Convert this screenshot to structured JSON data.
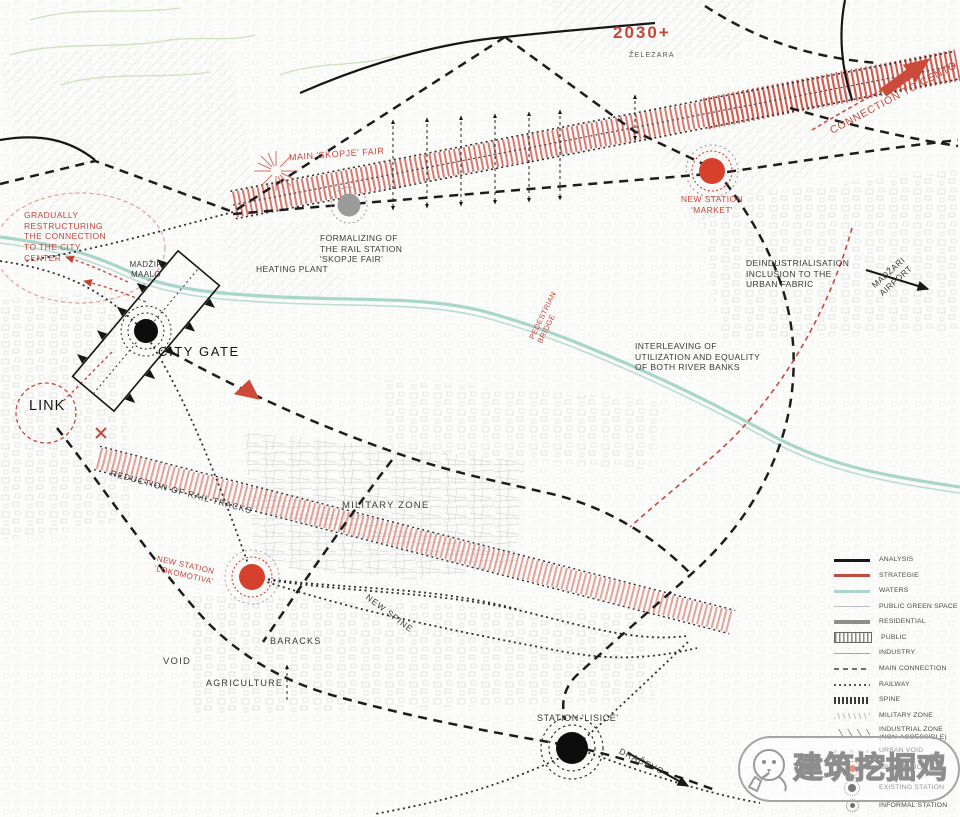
{
  "meta": {
    "year": "2030+",
    "district": "ŽELEZARA"
  },
  "labels": {
    "connection_cento": "CONNECTION TO CENTO",
    "main_fair": "MAIN 'SKOPJE' FAIR",
    "new_station_market": "NEW STATION\n'MARKET'",
    "formalizing": "FORMALIZING OF\nTHE RAIL STATION\n'SKOPJE FAIR'",
    "heating_plant": "HEATING PLANT",
    "deindustrialisation": "DEINDUSTRIALISATION\nINCLUSION TO THE\nURBAN FABRIC",
    "gradually": "GRADUALLY\nRESTRUCTURING\nTHE CONNECTION\nTO THE CITY\nCENTER",
    "madzir_maalo": "MADŽIR\nMAALO",
    "city_gate": "CITY GATE",
    "link": "LINK",
    "interleaving": "INTERLEAVING OF\nUTILIZATION AND EQUALITY\nOF BOTH RIVER BANKS",
    "madzari_airport": "MADŽARI\nAIRPORT",
    "pedestrian_bridge": "PEDESTRIAN\nBRIDGE",
    "reduction_rail": "REDUCTION OF RAIL TRACKS",
    "new_station_lokomotiva": "NEW STATION\n'LOKOMOTIVA'",
    "new_spine": "NEW SPINE",
    "baracks": "BARACKS",
    "void": "VOID",
    "agriculture": "AGRICULTURE",
    "military_zone": "MILITARY ZONE",
    "station_lisice": "STATION 'LISICE'",
    "dracevo": "DRAČEVO"
  },
  "legend": {
    "items": [
      {
        "label": "ANALYSIS",
        "key": "analysis"
      },
      {
        "label": "STRATEGIE",
        "key": "strategie"
      },
      {
        "label": "WATERS",
        "key": "waters"
      },
      {
        "label": "PUBLIC GREEN SPACE",
        "key": "green"
      },
      {
        "label": "RESIDENTIAL",
        "key": "residential"
      },
      {
        "label": "PUBLIC",
        "key": "public"
      },
      {
        "label": "INDUSTRY",
        "key": "industry"
      },
      {
        "label": "MAIN CONNECTION",
        "key": "mainconn"
      },
      {
        "label": "RAILWAY",
        "key": "railway"
      },
      {
        "label": "SPINE",
        "key": "spine"
      },
      {
        "label": "MILITARY ZONE",
        "key": "military"
      },
      {
        "label": "INDUSTRIAL ZONE\n(NON-ACCESSIBLE)",
        "key": "indzone"
      },
      {
        "label": "URBAN VOID",
        "key": "void"
      },
      {
        "label": "NEW STATION",
        "key": "newstation"
      },
      {
        "label": "EXISTING STATION",
        "key": "existstation"
      },
      {
        "label": "INFORMAL STATION",
        "key": "infstation"
      }
    ]
  },
  "watermark": {
    "text": "建筑挖掘鸡"
  },
  "colors": {
    "strategy_red": "#c24b3f",
    "station_red": "#d6402c",
    "waters_teal": "#a9d6ca",
    "analysis_black": "#161616",
    "residential_gray": "#8d8d8d"
  }
}
